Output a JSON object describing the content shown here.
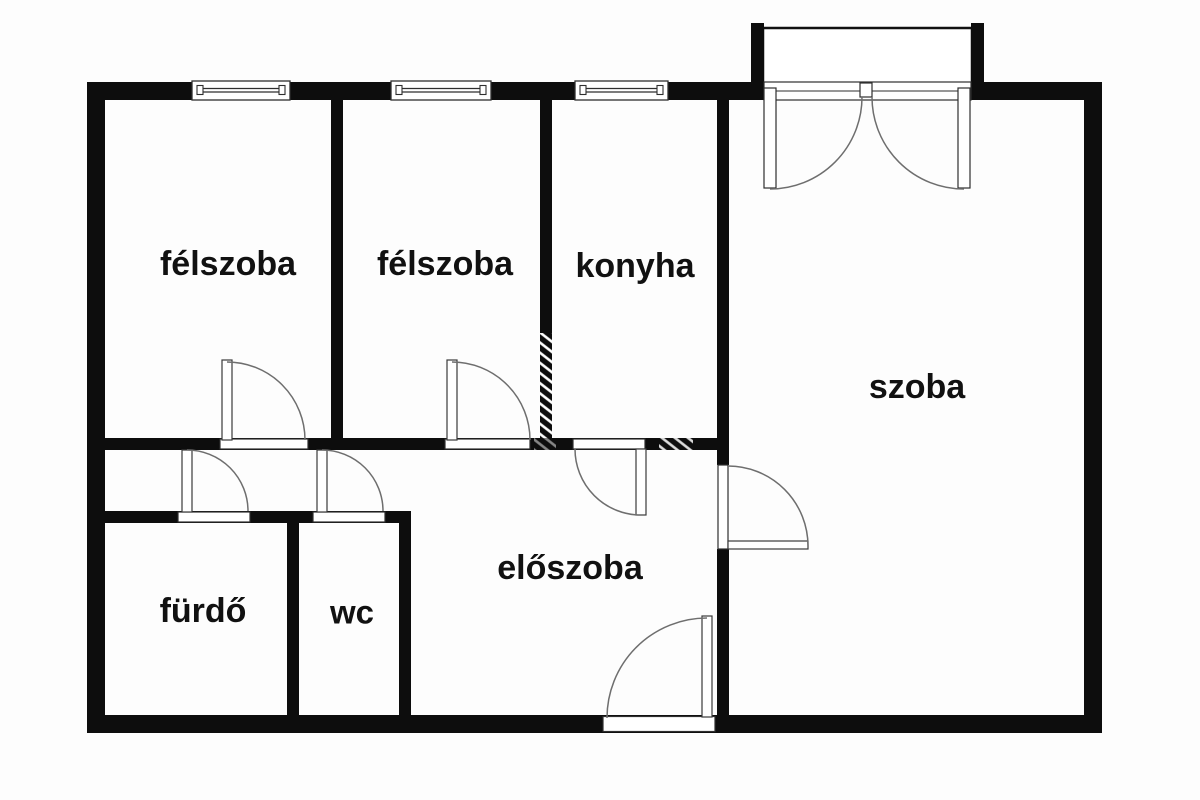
{
  "floorplan": {
    "type": "apartment-floor-plan",
    "background_color": "#fdfdfd",
    "wall_color": "#0d0d0d",
    "thin_line_color": "#2e2e2e",
    "door_arc_color": "#6e6e6e",
    "label_color": "#111111",
    "rooms": [
      {
        "name": "felszoba-1",
        "label": "félszoba"
      },
      {
        "name": "felszoba-2",
        "label": "félszoba"
      },
      {
        "name": "konyha",
        "label": "konyha"
      },
      {
        "name": "szoba",
        "label": "szoba"
      },
      {
        "name": "furdo",
        "label": "fürdő"
      },
      {
        "name": "wc",
        "label": "wc"
      },
      {
        "name": "eloszoba",
        "label": "előszoba"
      }
    ]
  }
}
